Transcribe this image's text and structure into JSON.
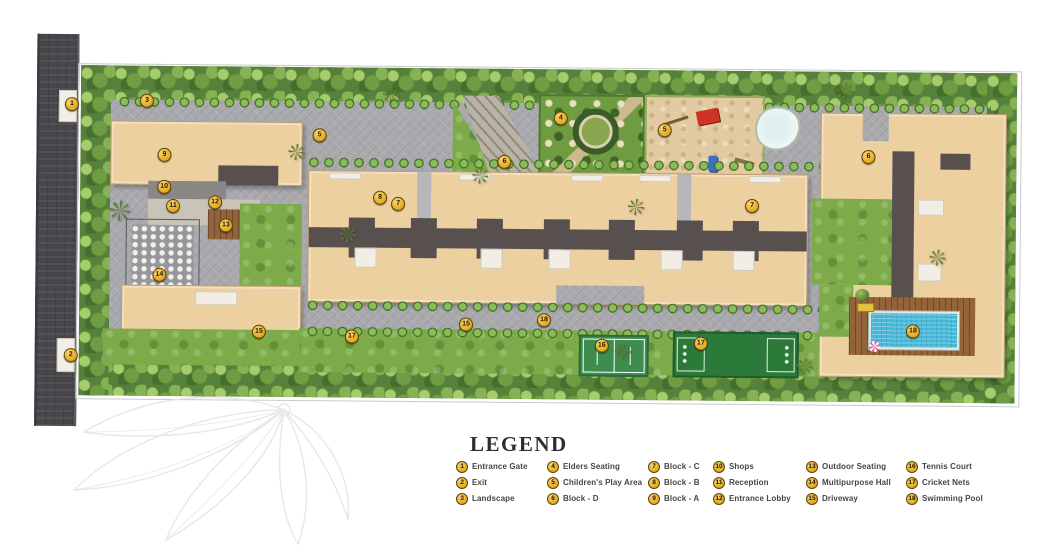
{
  "legend": {
    "title": "LEGEND",
    "items": [
      {
        "num": "1",
        "label": "Entrance Gate"
      },
      {
        "num": "2",
        "label": "Exit"
      },
      {
        "num": "3",
        "label": "Landscape"
      },
      {
        "num": "4",
        "label": "Elders Seating"
      },
      {
        "num": "5",
        "label": "Children's Play Area"
      },
      {
        "num": "6",
        "label": "Block - D"
      },
      {
        "num": "7",
        "label": "Block - C"
      },
      {
        "num": "8",
        "label": "Block - B"
      },
      {
        "num": "9",
        "label": "Block - A"
      },
      {
        "num": "10",
        "label": "Shops"
      },
      {
        "num": "11",
        "label": "Reception"
      },
      {
        "num": "12",
        "label": "Entrance Lobby"
      },
      {
        "num": "13",
        "label": "Outdoor Seating"
      },
      {
        "num": "14",
        "label": "Multipurpose Hall"
      },
      {
        "num": "15",
        "label": "Driveway"
      },
      {
        "num": "16",
        "label": "Tennis Court"
      },
      {
        "num": "17",
        "label": "Cricket Nets"
      },
      {
        "num": "18",
        "label": "Swimming Pool"
      }
    ]
  },
  "plan": {
    "markers": [
      {
        "num": "1",
        "x": 70,
        "y": 107
      },
      {
        "num": "2",
        "x": 71,
        "y": 358
      },
      {
        "num": "3",
        "x": 145,
        "y": 103
      },
      {
        "num": "5",
        "x": 318,
        "y": 136
      },
      {
        "num": "4",
        "x": 559,
        "y": 117
      },
      {
        "num": "5",
        "x": 663,
        "y": 128
      },
      {
        "num": "6",
        "x": 503,
        "y": 161
      },
      {
        "num": "6",
        "x": 867,
        "y": 153
      },
      {
        "num": "9",
        "x": 163,
        "y": 157
      },
      {
        "num": "10",
        "x": 163,
        "y": 189
      },
      {
        "num": "11",
        "x": 172,
        "y": 208
      },
      {
        "num": "12",
        "x": 214,
        "y": 204
      },
      {
        "num": "13",
        "x": 225,
        "y": 227
      },
      {
        "num": "14",
        "x": 159,
        "y": 277
      },
      {
        "num": "8",
        "x": 379,
        "y": 198
      },
      {
        "num": "7",
        "x": 397,
        "y": 204
      },
      {
        "num": "7",
        "x": 751,
        "y": 203
      },
      {
        "num": "15",
        "x": 259,
        "y": 333
      },
      {
        "num": "17",
        "x": 352,
        "y": 337
      },
      {
        "num": "15",
        "x": 466,
        "y": 324
      },
      {
        "num": "18",
        "x": 544,
        "y": 319
      },
      {
        "num": "16",
        "x": 602,
        "y": 344
      },
      {
        "num": "17",
        "x": 701,
        "y": 341
      },
      {
        "num": "18",
        "x": 913,
        "y": 327
      }
    ]
  },
  "palette": {
    "marker_fill": "#e8b42d",
    "marker_border": "#5f4408",
    "road": "#47474b",
    "building_tan": "#ecd0a0",
    "roof_gray": "#57504e",
    "grass_green": "#7dab4a",
    "tree_green": "#55813a",
    "paving_gray": "#a9a9ae",
    "pool_blue": "#49b9d9",
    "court_green": "#3e8c4e",
    "sand": "#e2cba2",
    "deck_brown": "#93633a",
    "legend_text": "#454545"
  }
}
